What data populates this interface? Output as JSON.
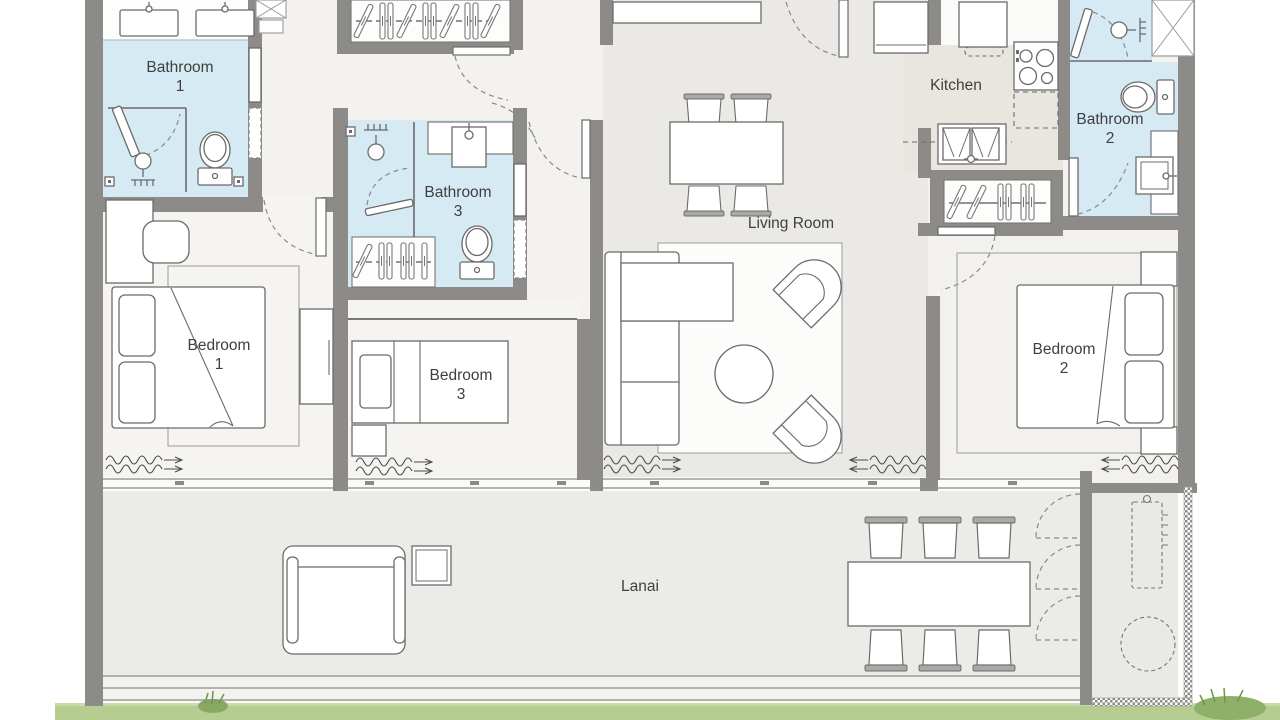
{
  "rooms": {
    "bathroom1": {
      "name": "Bathroom",
      "number": "1"
    },
    "bathroom2": {
      "name": "Bathroom",
      "number": "2"
    },
    "bathroom3": {
      "name": "Bathroom",
      "number": "3"
    },
    "bedroom1": {
      "name": "Bedroom",
      "number": "1"
    },
    "bedroom2": {
      "name": "Bedroom",
      "number": "2"
    },
    "bedroom3": {
      "name": "Bedroom",
      "number": "3"
    },
    "kitchen": {
      "name": "Kitchen"
    },
    "living_room": {
      "name": "Living Room"
    },
    "lanai": {
      "name": "Lanai"
    }
  },
  "colors": {
    "wall": "#8d8b88",
    "bathroom_fill": "#d6eaf4",
    "floor_light": "#f3f2ef",
    "floor_living": "#eae9e5",
    "floor_bedroom": "#f5f4f1",
    "floor_kitchen": "#e9e6e0",
    "lanai_fill": "#ebebe8",
    "grass": "#b6cd92",
    "furniture_line": "#6b6b6b"
  }
}
